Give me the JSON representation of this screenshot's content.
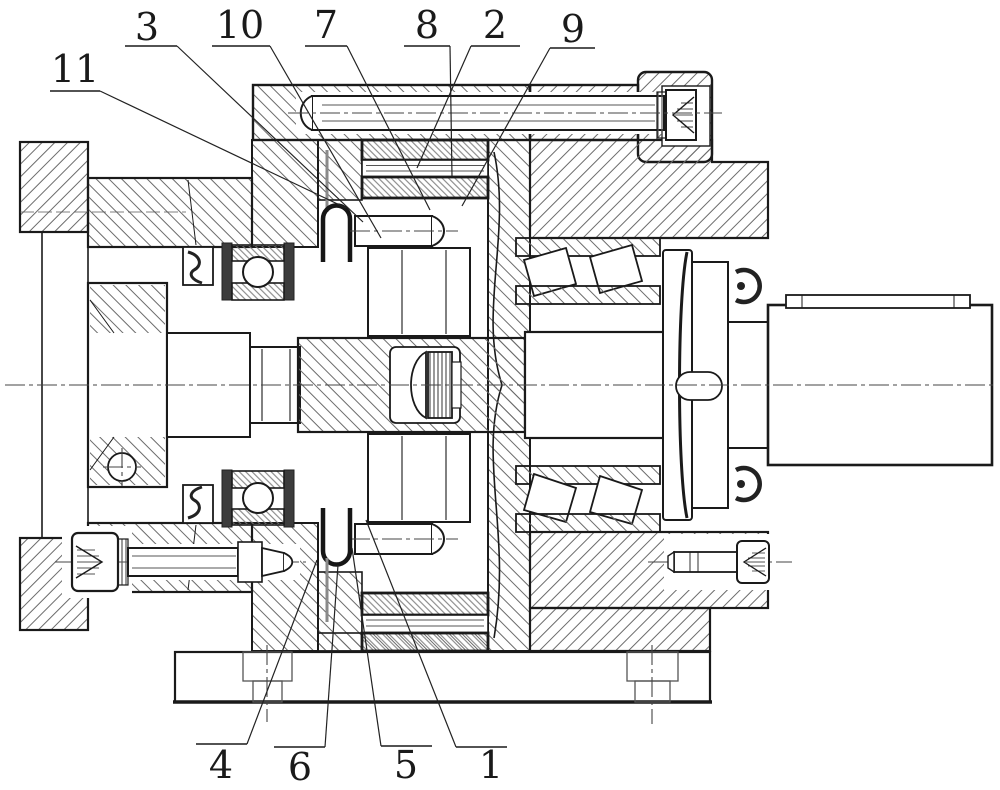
{
  "drawing": {
    "background_color": "#ffffff",
    "line_color": "#1a1a1a",
    "hatch_color": "#6b6b6b",
    "callouts": [
      {
        "label": "11",
        "lx": 75,
        "ly": 82,
        "ux1": 50,
        "ux2": 100,
        "uy": 91,
        "tx": 346,
        "ty": 208
      },
      {
        "label": "3",
        "lx": 147,
        "ly": 40,
        "ux1": 125,
        "ux2": 177,
        "uy": 46,
        "tx": 363,
        "ty": 222
      },
      {
        "label": "10",
        "lx": 240,
        "ly": 38,
        "ux1": 212,
        "ux2": 270,
        "uy": 46,
        "tx": 381,
        "ty": 238
      },
      {
        "label": "7",
        "lx": 326,
        "ly": 38,
        "ux1": 305,
        "ux2": 347,
        "uy": 46,
        "tx": 430,
        "ty": 210
      },
      {
        "label": "8",
        "lx": 427,
        "ly": 38,
        "ux1": 404,
        "ux2": 450,
        "uy": 46,
        "tx": 452,
        "ty": 176
      },
      {
        "label": "2",
        "lx": 495,
        "ly": 38,
        "ux1": 471,
        "ux2": 520,
        "uy": 46,
        "tx": 417,
        "ty": 168
      },
      {
        "label": "9",
        "lx": 573,
        "ly": 42,
        "ux1": 550,
        "ux2": 595,
        "uy": 48,
        "tx": 462,
        "ty": 206
      },
      {
        "label": "4",
        "lx": 221,
        "ly": 778,
        "ux1": 196,
        "ux2": 247,
        "uy": 744,
        "tx": 317,
        "ty": 560
      },
      {
        "label": "6",
        "lx": 300,
        "ly": 780,
        "ux1": 274,
        "ux2": 325,
        "uy": 747,
        "tx": 338,
        "ty": 565
      },
      {
        "label": "5",
        "lx": 406,
        "ly": 778,
        "ux1": 381,
        "ux2": 432,
        "uy": 746,
        "tx": 352,
        "ty": 548
      },
      {
        "label": "1",
        "lx": 491,
        "ly": 778,
        "ux1": 456,
        "ux2": 507,
        "uy": 747,
        "tx": 366,
        "ty": 520
      }
    ]
  }
}
